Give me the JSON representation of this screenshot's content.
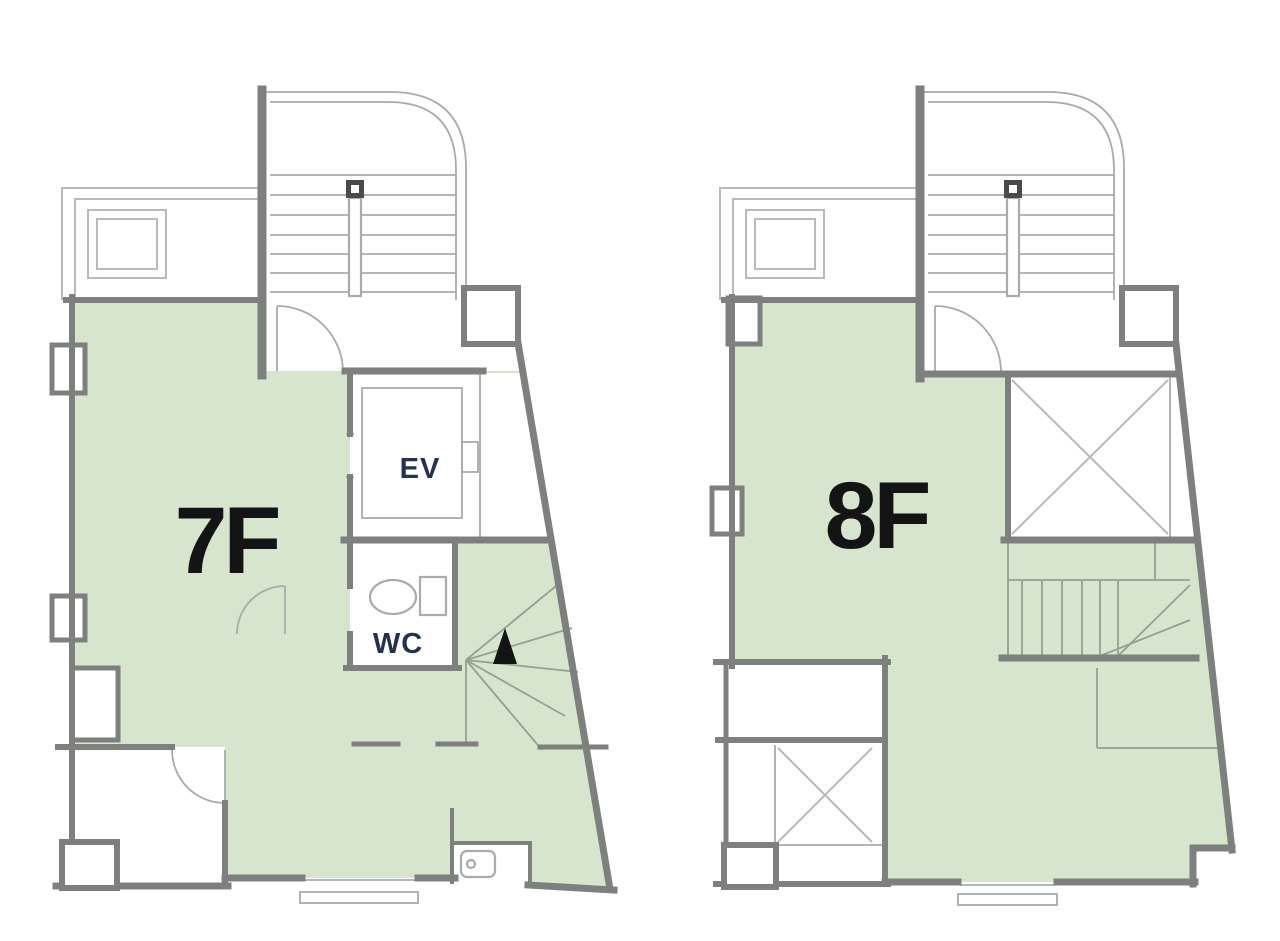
{
  "plans": [
    {
      "floor_label": "7F",
      "elevator_label": "EV",
      "wc_label": "WC"
    },
    {
      "floor_label": "8F"
    }
  ],
  "icons": {
    "toilet": "toilet-icon",
    "up_arrow": "stair-direction-arrow-icon"
  },
  "colors": {
    "leased_area_green": "#d7e5cf",
    "wall_gray": "#7d807d",
    "thin_line_gray": "#a8aca8",
    "balcony_line_gray": "#b7bbb7",
    "stair_line_green": "#93a28f",
    "floor_label_color": "#141414",
    "room_label_color": "#25324f",
    "background": "#ffffff"
  }
}
